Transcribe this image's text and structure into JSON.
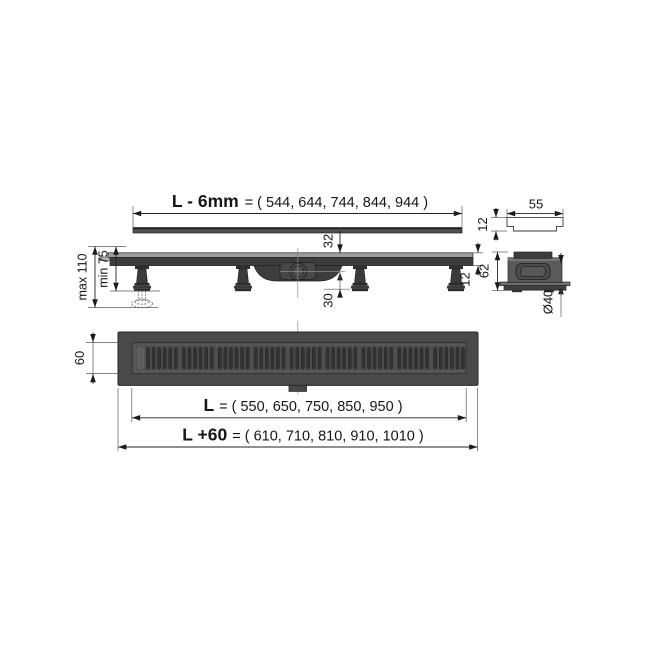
{
  "dims": {
    "grate_length_label": "L - 6mm",
    "grate_length_values": "= ( 544, 644, 744, 844, 944 )",
    "profile_width": "55",
    "profile_height": "12",
    "height_max": "max 110",
    "height_min": "min 75",
    "depth_top": "32",
    "depth_bottom": "30",
    "rim_height": "12",
    "body_height": "62",
    "outlet_diameter": "Ø40",
    "grate_width": "60",
    "channel_length_label": "L",
    "channel_length_values": "= ( 550, 650, 750, 850, 950 )",
    "overall_length_label": "L +60",
    "overall_length_values": "= ( 610, 710, 810, 910, 1010 )"
  },
  "top_view": {
    "grate": {
      "groups": 9,
      "slots_per_group": 6
    }
  },
  "colors": {
    "body_dark": "#3d3d3d",
    "body_mid": "#4a4a4a",
    "panel": "#4e4e4e",
    "slot": "#323232",
    "rim_light": "#9e9e9e",
    "end_body": "#5a5a5a",
    "line": "#222222",
    "background": "#ffffff"
  }
}
